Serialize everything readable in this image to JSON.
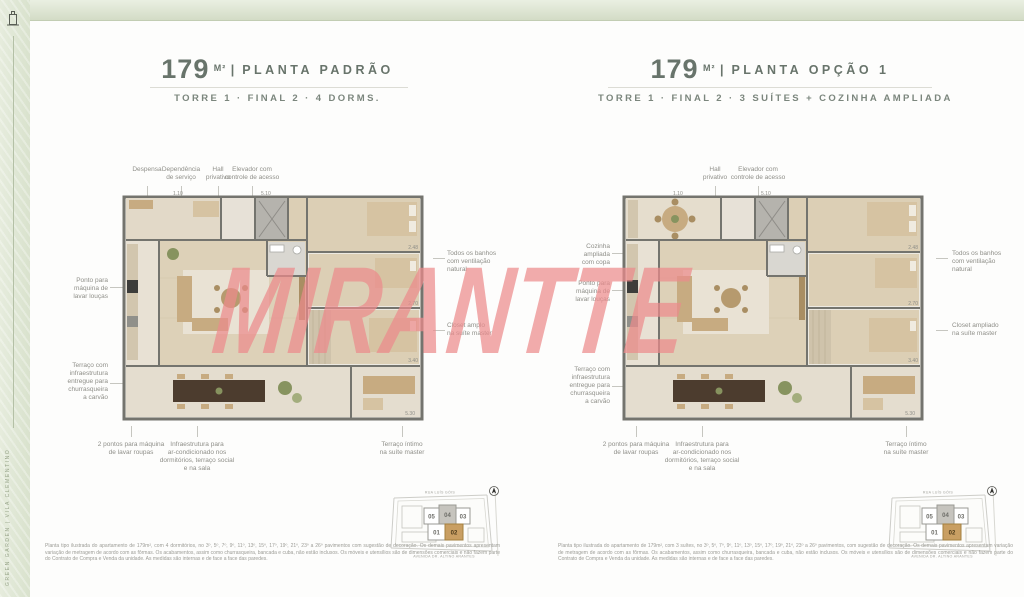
{
  "page": {
    "watermark": "MIRANTTE",
    "spine_text": "GREEN GARDEN | VILA CLEMENTINO",
    "colors": {
      "accent_sage": "#dfe6d7",
      "watermark_pink": "#eb8a8c",
      "title_green": "#68746b",
      "keyplan_highlight": "#c99f63"
    }
  },
  "plans": [
    {
      "area": "179",
      "unit": "M²",
      "sep": "|",
      "name": "PLANTA PADRÃO",
      "subtitle": "TORRE 1 · FINAL 2 · 4 DORMS.",
      "callouts_top": [
        "Despensa",
        "Dependência\nde serviço",
        "Hall\nprivativo",
        "Elevador com\ncontrole de acesso"
      ],
      "callouts_left": [
        "Ponto para\nmáquina de\nlavar louças",
        "Terraço com\ninfraestrutura\nentregue para\nchurrasqueira\na carvão"
      ],
      "callouts_right": [
        "Todos os banhos\ncom ventilação\nnatural",
        "Closet amplo\nna suíte master"
      ],
      "callouts_bottom": [
        "2 pontos para máquina\nde lavar roupas",
        "Infraestrutura para\nar-condicionado nos\ndormitórios, terraço social\ne na sala",
        "Terraço íntimo\nna suíte master"
      ],
      "dims": [
        "1.10",
        "5.10",
        "2.48",
        "2.70",
        "3.40",
        "5.30"
      ],
      "keyplan": {
        "units": [
          "05",
          "04",
          "03",
          "01",
          "02"
        ],
        "highlight": "02",
        "street_top": "RUA LUÍS GÓIS",
        "street_bottom": "AVENIDA DR. ALTINO ARANTES"
      },
      "disclaimer": "Planta tipo ilustrada do apartamento de 179m², com 4 dormitórios, no 3º, 5º, 7º, 9º, 11º, 13º, 15º, 17º, 19º, 21º, 23º a 26º pavimentos com sugestão de decoração. Os demais pavimentos apresentam variação de metragem de acordo com as fôrmas. Os acabamentos, assim como churrasqueira, bancada e cuba, não estão inclusos. Os móveis e utensílios são de dimensões comerciais e não fazem parte do Contrato de Compra e Venda da unidade. As medidas são internas e de face a face das paredes."
    },
    {
      "area": "179",
      "unit": "M²",
      "sep": "|",
      "name": "PLANTA OPÇÃO 1",
      "subtitle": "TORRE 1 · FINAL 2 · 3 SUÍTES + COZINHA AMPLIADA",
      "callouts_top": [
        "Hall\nprivativo",
        "Elevador com\ncontrole de acesso"
      ],
      "callouts_left": [
        "Cozinha\nampliada\ncom copa",
        "Ponto para\nmáquina de\nlavar louças",
        "Terraço com\ninfraestrutura\nentregue para\nchurrasqueira\na carvão"
      ],
      "callouts_right": [
        "Todos os banhos\ncom ventilação\nnatural",
        "Closet ampliado\nna suíte master"
      ],
      "callouts_bottom": [
        "2 pontos para máquina\nde lavar roupas",
        "Infraestrutura para\nar-condicionado nos\ndormitórios, terraço social\ne na sala",
        "Terraço íntimo\nna suíte master"
      ],
      "dims": [
        "1.10",
        "5.10",
        "2.48",
        "2.70",
        "3.40",
        "5.30"
      ],
      "keyplan": {
        "units": [
          "05",
          "04",
          "03",
          "01",
          "02"
        ],
        "highlight": "02",
        "street_top": "RUA LUÍS GÓIS",
        "street_bottom": "AVENIDA DR. ALTINO ARANTES"
      },
      "disclaimer": "Planta tipo ilustrada do apartamento de 179m², com 3 suítes, no 3º, 5º, 7º, 9º, 11º, 13º, 15º, 17º, 19º, 21º, 23º a 26º pavimentos, com sugestão de decoração. Os demais pavimentos apresentam variação de metragem de acordo com as fôrmas. Os acabamentos, assim como churrasqueira, bancada e cuba, não estão inclusos. Os móveis e utensílios são de dimensões comerciais e não fazem parte do Contrato de Compra e Venda da unidade. As medidas são internas e de face a face das paredes."
    }
  ]
}
